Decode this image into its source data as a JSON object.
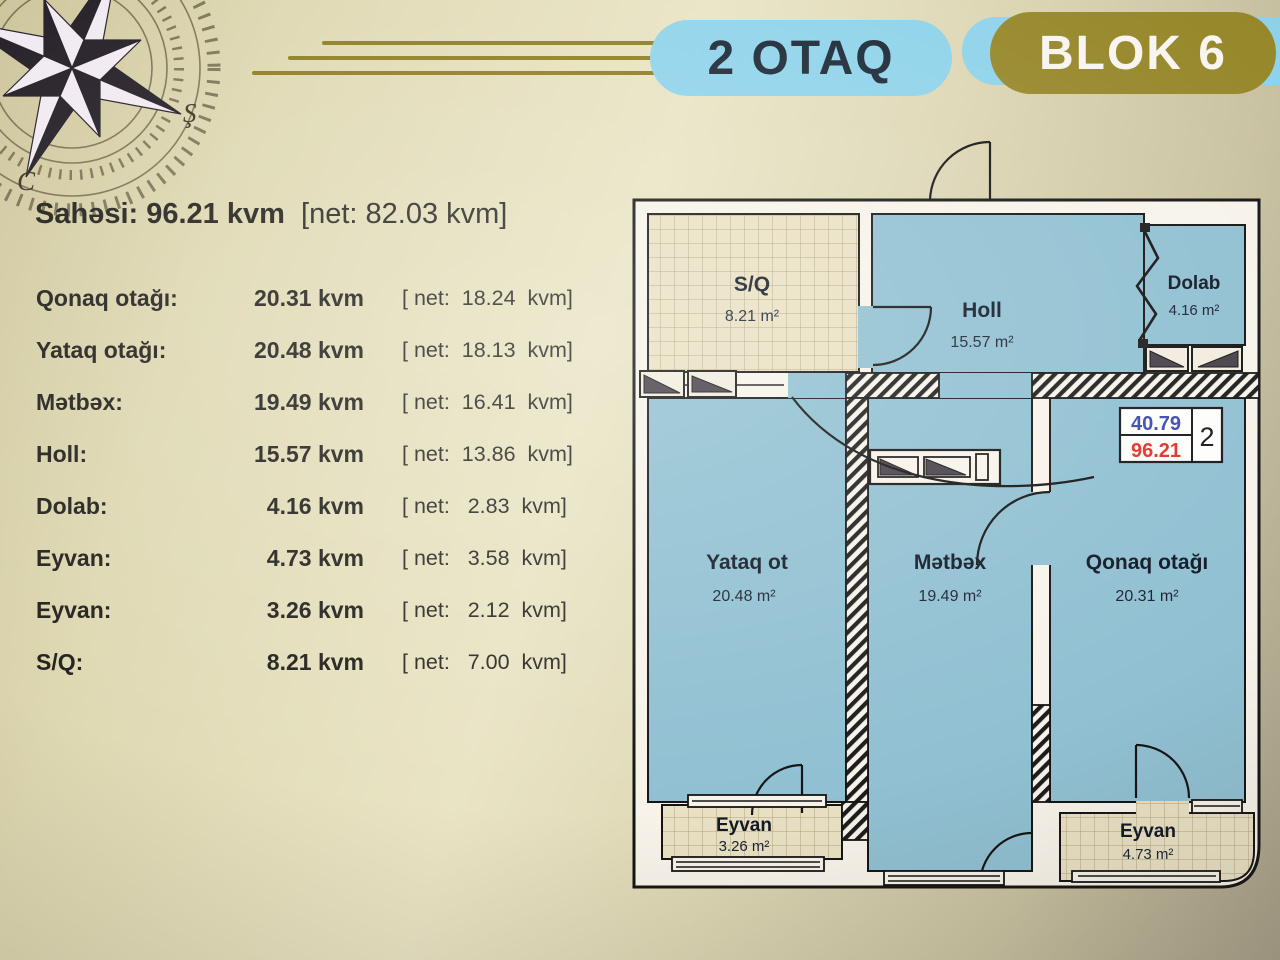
{
  "header": {
    "rooms_pill": "2 OTAQ",
    "block_pill": "BLOK 6"
  },
  "compass": {
    "label_sh": "Ş",
    "label_c": "C"
  },
  "summary": {
    "label": "Sahəsi:",
    "value": "96.21 kvm",
    "net": "[net: 82.03 kvm]"
  },
  "rooms_table": {
    "rows": [
      {
        "label": "Qonaq otağı:",
        "value": "20.31 kvm",
        "net": "[ net:  18.24  kvm]"
      },
      {
        "label": "Yataq otağı:",
        "value": "20.48 kvm",
        "net": "[ net:  18.13  kvm]"
      },
      {
        "label": "Mətbəx:",
        "value": "19.49 kvm",
        "net": "[ net:  16.41  kvm]"
      },
      {
        "label": "Holl:",
        "value": "15.57 kvm",
        "net": "[ net:  13.86  kvm]"
      },
      {
        "label": "Dolab:",
        "value": "4.16 kvm",
        "net": "[ net:   2.83  kvm]"
      },
      {
        "label": "Eyvan:",
        "value": "4.73 kvm",
        "net": "[ net:   3.58  kvm]"
      },
      {
        "label": "Eyvan:",
        "value": "3.26 kvm",
        "net": "[ net:   2.12  kvm]"
      },
      {
        "label": "S/Q:",
        "value": "8.21 kvm",
        "net": "[ net:   7.00  kvm]"
      }
    ]
  },
  "floorplan": {
    "rooms": [
      {
        "name": "S/Q",
        "area": "8.21 m²"
      },
      {
        "name": "Holl",
        "area": "15.57 m²"
      },
      {
        "name": "Dolab",
        "area": "4.16 m²"
      },
      {
        "name": "Yataq ot",
        "area": "20.48 m²"
      },
      {
        "name": "Mətbəx",
        "area": "19.49 m²"
      },
      {
        "name": "Qonaq otağı",
        "area": "20.31 m²"
      },
      {
        "name": "Eyvan",
        "area": "3.26 m²"
      },
      {
        "name": "Eyvan",
        "area": "4.73 m²"
      }
    ],
    "badge": {
      "value_blue": "40.79",
      "value_red": "96.21",
      "unit": "2"
    }
  },
  "colors": {
    "pill_blue": "#8fd3ea",
    "pill_gold": "#97882b",
    "deco_line": "#8d7e1f",
    "room_blue": "#90c0d2",
    "tile_beige": "#e9e1c4",
    "wall_white": "#f7f3ea",
    "badge_blue": "#3a4aae",
    "badge_red": "#e03128"
  }
}
